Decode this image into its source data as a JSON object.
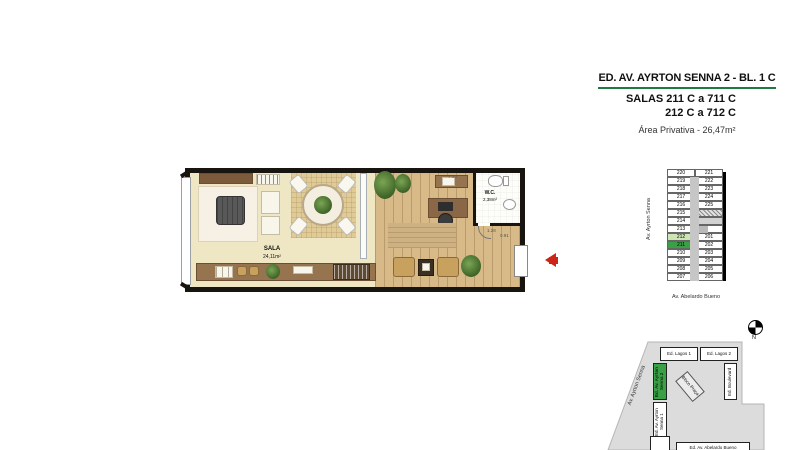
{
  "title_block": {
    "building": "ED. AV. AYRTON SENNA 2 - BL. 1 C",
    "salas_line1": "SALAS 211 C a 711 C",
    "salas_line2": "212 C a 712 C",
    "area_privativa": "Área Privativa - 26,47m²",
    "underline_color": "#1e7a40"
  },
  "floor_plan": {
    "sala": {
      "name": "SALA",
      "area": "24,11m²"
    },
    "wc": {
      "name": "W.C.",
      "area": "2,38m²"
    },
    "dims": {
      "top": "7.10",
      "wc_door": "1.28",
      "entry": "0.91"
    }
  },
  "key_plan": {
    "street_left": "Av. Ayrton Senna",
    "street_bottom": "Av. Abelardo Bueno",
    "left_col": [
      "220",
      "219",
      "218",
      "217",
      "216",
      "215",
      "214",
      "213",
      "212",
      "211",
      "210",
      "209",
      "208",
      "207"
    ],
    "right_col_top": [
      "221",
      "222",
      "223",
      "224",
      "225"
    ],
    "right_col_bottom": [
      "201",
      "202",
      "203",
      "204",
      "205",
      "206"
    ],
    "highlighted_unit_dark": "211",
    "highlighted_unit_light": "212",
    "colors": {
      "dark_green": "#3aa045",
      "light_green": "#cde4b5"
    }
  },
  "site_plan": {
    "north": "N",
    "street_diagonal": "Av. Ayrton Senna",
    "buildings": {
      "lagos1": "Ed. Lagos 1",
      "lagos2": "Ed. Lagos 2",
      "senna2": "Ed. Av. Ayrton Senna 2",
      "senna1": "Ed. Av. Ayrton Senna 1",
      "boulevard": "Ed. Boulevard",
      "praca": "Bloco Praça",
      "abelardo": "Ed. Av. Abelardo Bueno"
    },
    "highlight_color": "#3aa045"
  }
}
